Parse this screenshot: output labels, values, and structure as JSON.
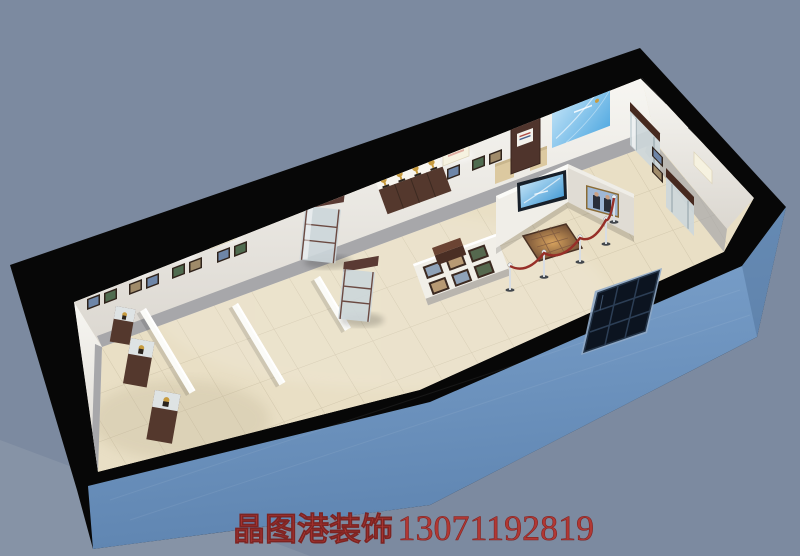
{
  "scene": {
    "kind": "3d-cutaway-render",
    "subject": "exhibition-hall-interior",
    "objects": [
      "cut-wall-band",
      "blue-facade",
      "entrance-door",
      "tile-floor",
      "back-wall",
      "sign-panels",
      "photo-frames",
      "memorial-wood-panel",
      "blue-graphic-panel",
      "glass-display-cabinets",
      "trophy-counter",
      "display-pedestals",
      "tv-screen",
      "leaders-photo",
      "floor-relief-exhibit",
      "rope-barrier"
    ]
  },
  "watermark": {
    "brand": "晶图港装饰",
    "phone": "13071192819"
  },
  "colors": {
    "background": "#7c8aa0",
    "background_light": "#8e9aac",
    "cut_black": "#070707",
    "facade_light": "#82a8d2",
    "facade_dark": "#5f85b1",
    "floor": "#e9dfc5",
    "tile_line": "#cfc5a9",
    "wall_white": "#f2f0ea",
    "wainscot_gray": "#a7a7aa",
    "wood_brown": "#54382d",
    "wood_dark": "#3c2a21",
    "beige_pedestal": "#dcc9a0",
    "sky_panel_light": "#cfeafa",
    "sky_panel_blue": "#57ace2",
    "tv_light": "#d8effc",
    "tv_blue": "#2f8fd0",
    "gold": "#c79b3f",
    "rope_red": "#972f28",
    "door_dark": "#0c1420",
    "watermark_red": "#b5342f"
  }
}
